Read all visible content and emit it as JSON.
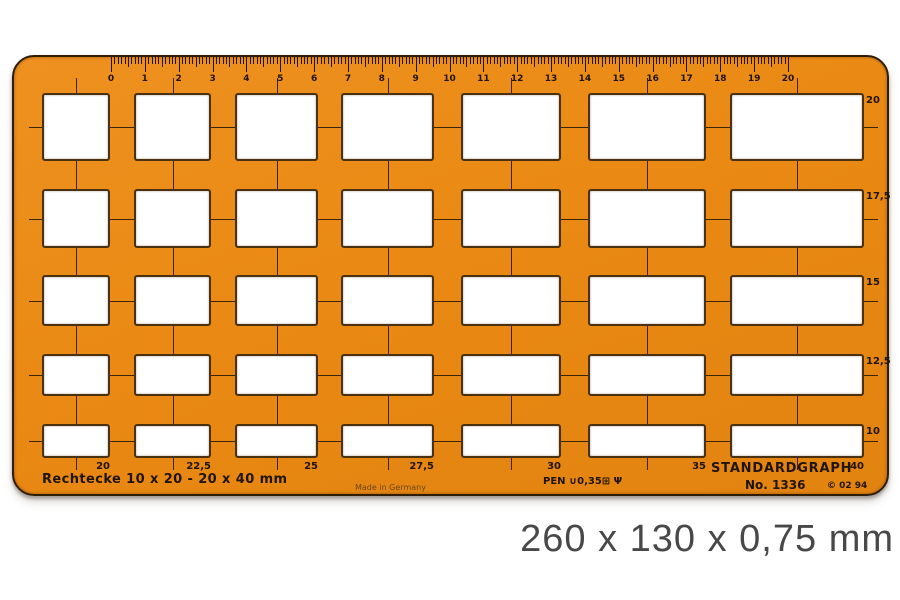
{
  "product": {
    "type_label": "Rechtecke  10 x 20 - 20 x 40 mm",
    "made_in": "Made in Germany",
    "pen_marking": "PEN ∪0,35⊞ Ψ",
    "brand": "STANDARDGRAPH",
    "model": "No. 1336",
    "copyright": "© 02 94",
    "dimensions_caption": "260 x 130 x 0,75 mm"
  },
  "ruler": {
    "numbers": [
      "0",
      "1",
      "2",
      "3",
      "4",
      "5",
      "6",
      "7",
      "8",
      "9",
      "10",
      "11",
      "12",
      "13",
      "14",
      "15",
      "16",
      "17",
      "18",
      "19",
      "20"
    ]
  },
  "grid": {
    "rows": 5,
    "columns": 7,
    "row_height_labels": [
      "20",
      "17,5",
      "15",
      "12,5",
      "10"
    ],
    "column_width_labels": [
      "20",
      "22,5",
      "25",
      "27,5",
      "30",
      "35",
      "40"
    ]
  },
  "colors": {
    "template_orange": "#EA8A14",
    "edge_brown": "#2F1D05",
    "ink": "#201403",
    "alignment_line": "#3A250B",
    "cutout_white": "#FFFFFF",
    "caption_gray": "#484848"
  }
}
